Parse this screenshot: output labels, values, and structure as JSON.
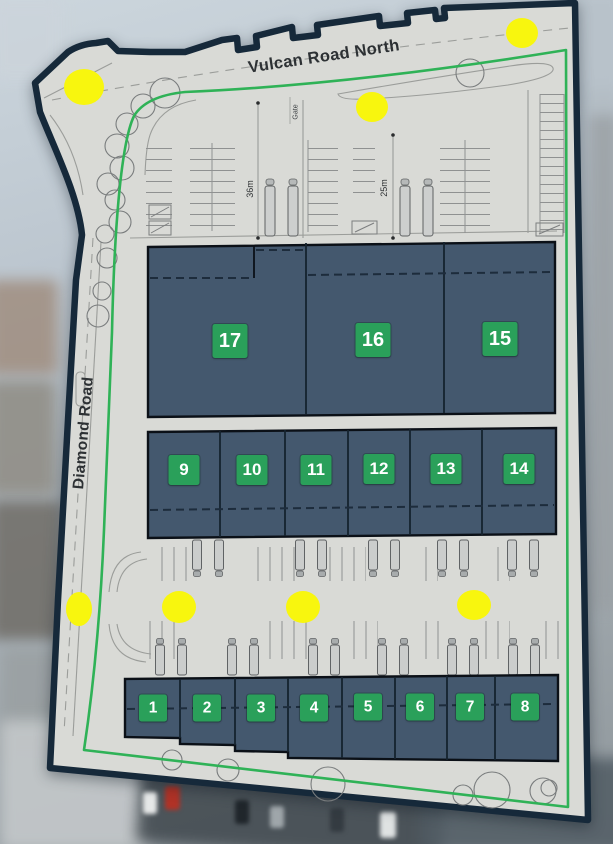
{
  "roads": {
    "north_road": "Vulcan Road North",
    "west_road": "Diamond Road"
  },
  "annotations": {
    "gate": "Gate",
    "dimension_left": "36m",
    "dimension_right": "25m"
  },
  "units": [
    "1",
    "2",
    "3",
    "4",
    "5",
    "6",
    "7",
    "8",
    "9",
    "10",
    "11",
    "12",
    "13",
    "14",
    "15",
    "16",
    "17"
  ],
  "markers": {
    "yellow_dot_count": 7
  },
  "colors": {
    "badge_green": "#2aa05a",
    "unit_fill": "#44586e",
    "boundary_navy": "#16293a",
    "boundary_green": "#2fb257",
    "highlight_yellow": "#f8f60e",
    "plan_grey": "#d9dad6"
  }
}
